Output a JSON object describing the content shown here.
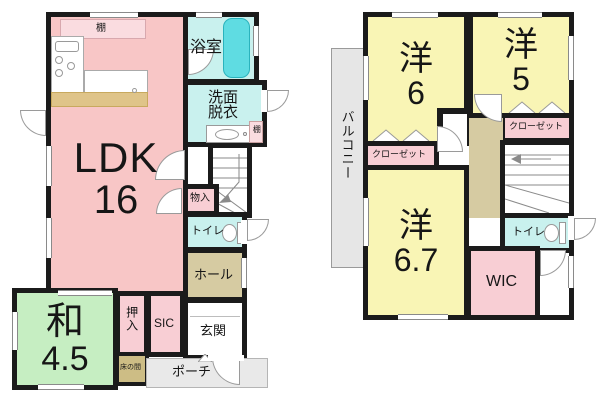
{
  "floor1": {
    "ldk": {
      "name": "LDK",
      "size": "16"
    },
    "washitsu": {
      "name": "和",
      "size": "4.5"
    },
    "bath": "浴室",
    "washroom": [
      "洗面",
      "脱衣"
    ],
    "toilet": "トイレ",
    "hall": "ホール",
    "entrance": "玄関",
    "porch": "ポーチ",
    "sic": "SIC",
    "oshiire": "押入",
    "storage": "物入",
    "tokonoma": "床の間",
    "shelf_kitchen": "棚",
    "shelf_washroom": "棚"
  },
  "floor2": {
    "western6": {
      "name": "洋",
      "size": "6"
    },
    "western5": {
      "name": "洋",
      "size": "5"
    },
    "western67": {
      "name": "洋",
      "size": "6.7"
    },
    "balcony": "バルコニー",
    "closet_a": "クローゼット",
    "closet_b": "クローゼット",
    "wic": "WIC",
    "toilet": "トイレ"
  },
  "colors": {
    "wall": "#1b1b1b",
    "ldk": "#f8c6c6",
    "closet_pink": "#f8ced4",
    "tatami": "#c6eec2",
    "western": "#f9f5b5",
    "water": "#c9f1ee",
    "bathtub": "#5fdce2",
    "hall": "#d6cba2",
    "counter": "#dfc489",
    "tokonoma": "#cdbd85",
    "porch": "#e9e9e9",
    "balcony": "#e6e6e6",
    "shelf": "#fadce0"
  }
}
